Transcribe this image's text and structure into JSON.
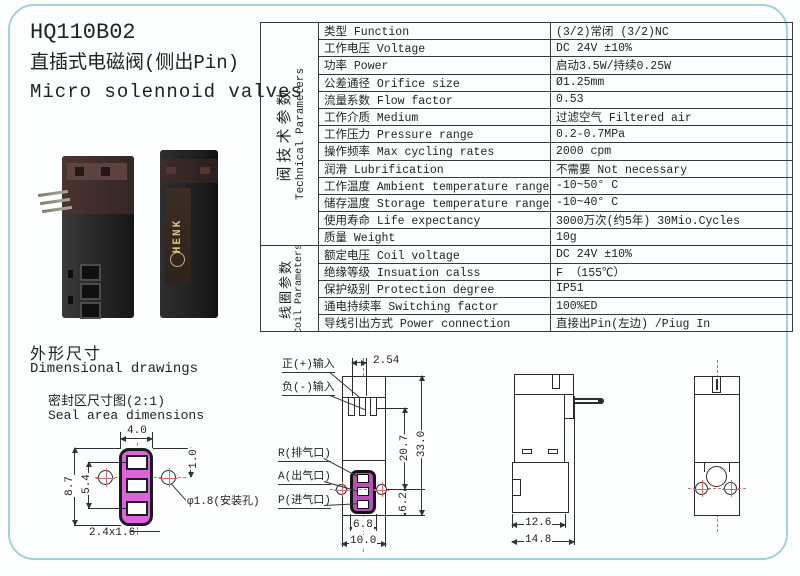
{
  "header": {
    "product_code": "HQ110B02",
    "subtitle_zh": "直插式电磁阀(侧出Pin)",
    "subtitle_en": "Micro solennoid valves"
  },
  "photos": {
    "brand_label": "HENK"
  },
  "table": {
    "groups": [
      {
        "zh": "阀技术参数",
        "en": "Technical Parameters"
      },
      {
        "zh": "线圈参数",
        "en": "Coil Parameters"
      }
    ],
    "rows": [
      {
        "param": "类型 Function",
        "value": "(3/2)常闭 (3/2)NC"
      },
      {
        "param": "工作电压 Voltage",
        "value": "DC 24V ±10%"
      },
      {
        "param": "功率 Power",
        "value": "启动3.5W/持续0.25W"
      },
      {
        "param": "公差通径 Orifice size",
        "value": "Ø1.25mm"
      },
      {
        "param": "流量系数 Flow factor",
        "value": "0.53"
      },
      {
        "param": "工作介质 Medium",
        "value": "过滤空气 Filtered air"
      },
      {
        "param": "工作压力 Pressure range",
        "value": "0.2-0.7MPa"
      },
      {
        "param": "操作频率 Max cycling rates",
        "value": "2000 cpm"
      },
      {
        "param": "润滑 Lubrification",
        "value": "不需要 Not necessary"
      },
      {
        "param": "工作温度 Ambient temperature range",
        "value": "-10~50° C"
      },
      {
        "param": "储存温度 Storage temperature range",
        "value": "-10~40° C"
      },
      {
        "param": "使用寿命 Life expectancy",
        "value": "3000万次(约5年) 30Mio.Cycles"
      },
      {
        "param": "质量 Weight",
        "value": "10g"
      },
      {
        "param": "额定电压 Coil voltage",
        "value": "DC 24V ±10%"
      },
      {
        "param": "绝缘等级 Insuation calss",
        "value": "F （155℃）"
      },
      {
        "param": "保护级别 Protection degree",
        "value": "IP51"
      },
      {
        "param": "通电持续率 Switching factor",
        "value": "100%ED"
      },
      {
        "param": "导线引出方式 Power connection",
        "value": "直接出Pin(左边) /Piug In"
      }
    ]
  },
  "dim": {
    "heading_zh": "外形尺寸",
    "heading_en": "Dimensional drawings",
    "seal": {
      "title_zh": "密封区尺寸图(2:1)",
      "title_en": "Seal area dimensions",
      "d_width": "4.0",
      "d_offset": "1.0",
      "d_height": "8.7",
      "d_inner": "5.4",
      "d_port": "2.4x1.6",
      "d_hole": "φ1.8(安装孔)"
    },
    "front": {
      "lbl_pos": "正(+)输入",
      "lbl_neg": "负(-)输入",
      "lbl_r": "R(排气口)",
      "lbl_a": "A(出气口)",
      "lbl_p": "P(进气口)",
      "d_pitch": "2.54",
      "d_upper": "20.7",
      "d_total": "33.0",
      "d_lower": "6.2",
      "d_ports": "6.8",
      "d_width": "10.0"
    },
    "side": {
      "d_body": "12.6",
      "d_total": "14.8"
    }
  },
  "colors": {
    "frame_blue": "#9ed2dc",
    "seal_magenta": "#df63df",
    "port_purple": "#b44fb4",
    "centerline_red": "#cf6f6f",
    "line_black": "#2e2e2e"
  }
}
